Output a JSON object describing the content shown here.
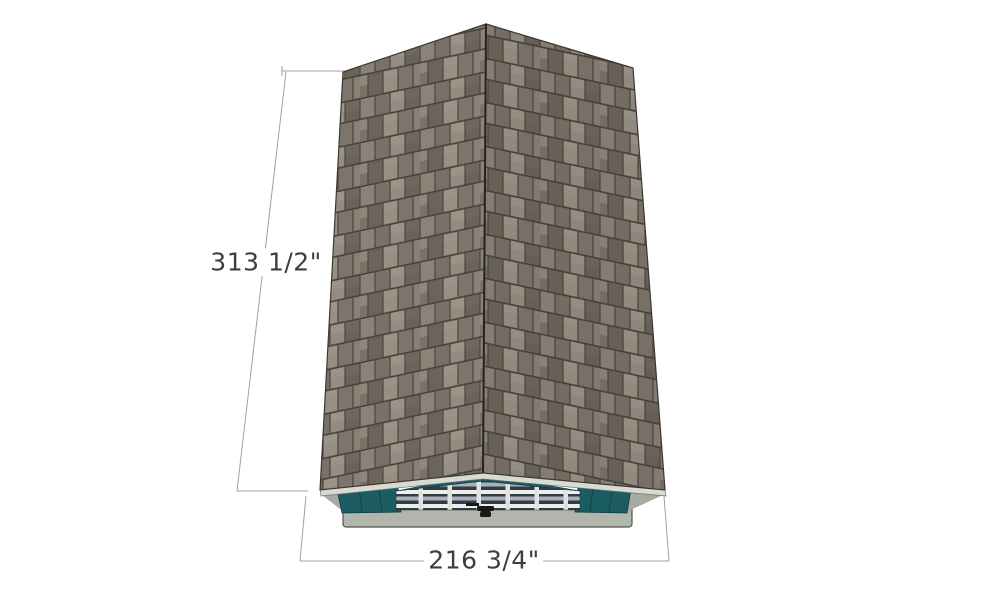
{
  "diagram": {
    "subject": "gable-roof-shed-top-front-view",
    "dimensions": {
      "height_label": "313 1/2\"",
      "width_label": "216 3/4\""
    }
  },
  "colors": {
    "background": "#ffffff",
    "shingle_base": "#847c71",
    "shingle_light": "#958d81",
    "shingle_dark": "#6e675e",
    "shingle_gap": "#46413a",
    "roof_outline": "#3d382f",
    "ridge": "#26231e",
    "fascia": "#d8dad4",
    "fascia_edge": "#70706a",
    "wall_teal": "#1b5b62",
    "teal_seam": "#0e444b",
    "teal_outline": "#0b3940",
    "door_dark": "#333b45",
    "door_white": "#edefeb",
    "door_blue": "#a8b1bc",
    "door_stile": "#dfe2dd",
    "base_gray": "#b2b6ad",
    "base_outline": "#50544c",
    "shadow_gray": "#a6aaa1",
    "handle": "#17181a",
    "dim_line": "#a0a0a0",
    "dim_text": "#3e3e3e"
  }
}
